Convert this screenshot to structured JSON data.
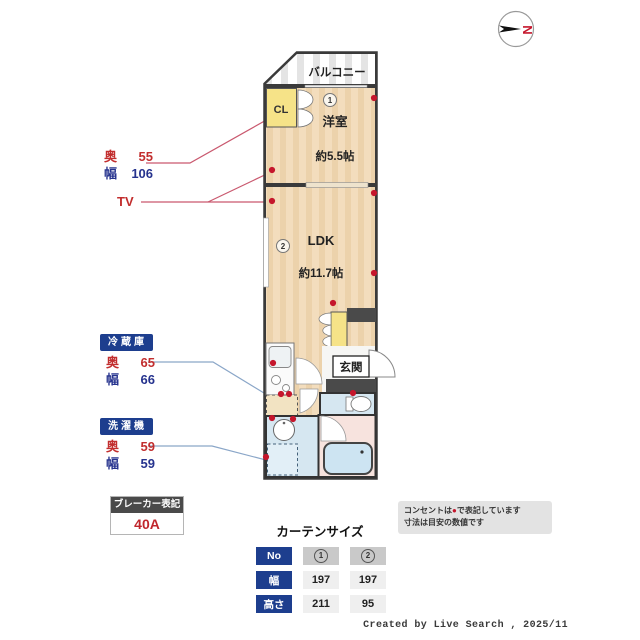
{
  "compass": {
    "letter": "N"
  },
  "plan": {
    "balcony_label": "バルコニー",
    "closet_label": "CL",
    "room1_no": "1",
    "room1_name": "洋室",
    "room1_size": "約5.5帖",
    "room2_no": "2",
    "room2_name": "LDK",
    "room2_size": "約11.7帖",
    "entrance_label": "玄関"
  },
  "labels": {
    "cl_dims": {
      "depth_label": "奥",
      "depth": "55",
      "width_label": "幅",
      "width": "106"
    },
    "tv": "TV",
    "fridge": {
      "title": "冷蔵庫",
      "depth_label": "奥",
      "depth": "65",
      "width_label": "幅",
      "width": "66"
    },
    "washer": {
      "title": "洗濯機",
      "depth_label": "奥",
      "depth": "59",
      "width_label": "幅",
      "width": "59"
    },
    "breaker": {
      "title": "ブレーカー表記",
      "value": "40A"
    }
  },
  "notes": {
    "line1_pre": "コンセントは",
    "line1_sym": "●",
    "line1_post": "で表記しています",
    "line2": "寸法は目安の数値です"
  },
  "curtain": {
    "title": "カーテンサイズ",
    "row_headers": [
      "No",
      "幅",
      "高さ"
    ],
    "columns": [
      {
        "no": "1",
        "width": "197",
        "height": "211"
      },
      {
        "no": "2",
        "width": "197",
        "height": "95"
      }
    ]
  },
  "footer": "Created by Live Search , 2025/11",
  "colors": {
    "accent_navy": "#1d3e8e",
    "dim_red": "#c22e2e",
    "dim_blue": "#26338e",
    "outlet_red": "#c5162c",
    "floor_peach": "#f3ddbd",
    "closet_yellow": "#f6e388",
    "wet_blue": "#d6e7f1",
    "bath_pink": "#f7e3de",
    "wall_dark": "#3a3a3a"
  }
}
